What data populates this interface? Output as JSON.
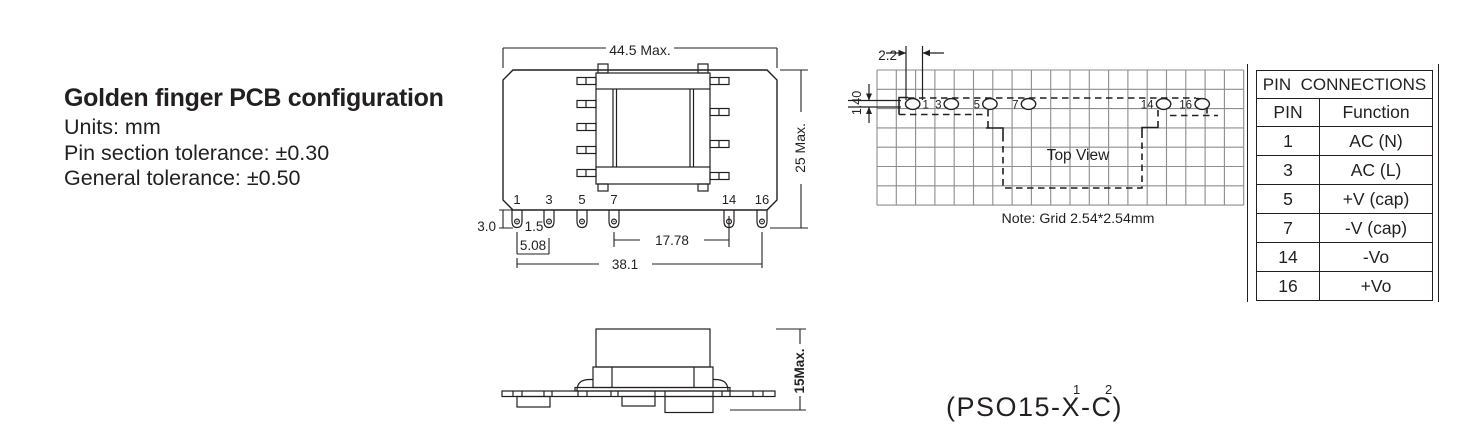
{
  "info": {
    "title": "Golden finger PCB configuration",
    "units": "Units: mm",
    "pin_tolerance": "Pin section tolerance: ±0.30",
    "general_tolerance": "General tolerance: ±0.50"
  },
  "front_view": {
    "dim_width": "44.5 Max.",
    "dim_height": "25 Max.",
    "dim_pin_length": "3.0",
    "dim_finger_width": "1.5",
    "dim_pitch": "5.08",
    "dim_mid_span": "17.78",
    "dim_total_span": "38.1",
    "pin_labels": [
      "1",
      "3",
      "5",
      "7",
      "14",
      "16"
    ]
  },
  "side_view": {
    "dim_height": "15Max."
  },
  "top_view": {
    "title": "Top View",
    "note": "Note: Grid 2.54*2.54mm",
    "dim_offset_x": "2.2",
    "dim_offset_y": "1.40",
    "pin_labels": [
      "1",
      "3",
      "5",
      "7",
      "14",
      "16"
    ]
  },
  "pin_table": {
    "title": "PIN  CONNECTIONS",
    "col_pin": "PIN",
    "col_function": "Function",
    "rows": [
      {
        "pin": "1",
        "function": "AC (N)"
      },
      {
        "pin": "3",
        "function": "AC (L)"
      },
      {
        "pin": "5",
        "function": "+V (cap)"
      },
      {
        "pin": "7",
        "function": "-V (cap)"
      },
      {
        "pin": "14",
        "function": "-Vo"
      },
      {
        "pin": "16",
        "function": "+Vo"
      }
    ]
  },
  "model": {
    "text": "(PSO15-X-C)",
    "sup1": "1",
    "sup2": "2"
  },
  "colors": {
    "ink": "#231f20",
    "grid": "#8d8d8d"
  }
}
